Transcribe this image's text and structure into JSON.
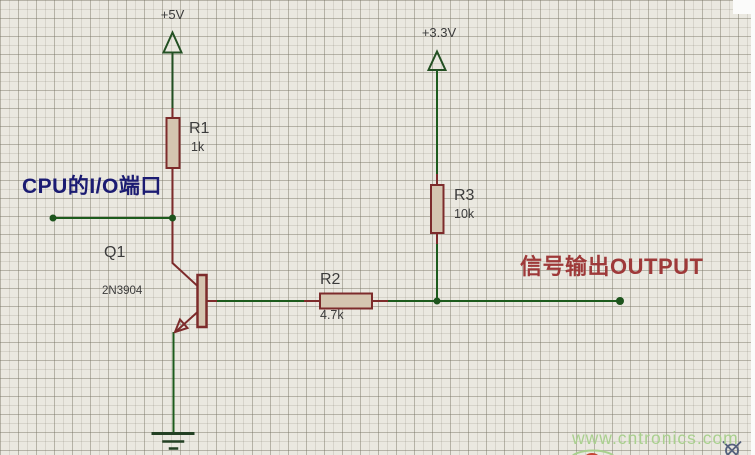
{
  "colors": {
    "background": "#eae8e0",
    "grid_line": "#d2cfc4",
    "wire": "#1c5b1c",
    "pin": "#7d2b2b",
    "component_fill": "#d5c5b0",
    "power": "#235023",
    "ground": "#234023",
    "junction": "#1d541d",
    "label_text": "#3c3c3c",
    "cpu_label": "#1b1b72",
    "output_label": "#9e3939",
    "watermark": "#a9d08e",
    "crosshair": "#54617c",
    "logo_red": "#c74433"
  },
  "power_rails": {
    "v5": "+5V",
    "v33": "+3.3V"
  },
  "components": {
    "r1": {
      "ref": "R1",
      "value": "1k"
    },
    "r2": {
      "ref": "R2",
      "value": "4.7k"
    },
    "r3": {
      "ref": "R3",
      "value": "10k"
    },
    "q1": {
      "ref": "Q1",
      "value": "2N3904"
    }
  },
  "annotations": {
    "cpu_io": "CPU的I/O端口",
    "output": "信号输出OUTPUT"
  },
  "watermark": {
    "text": "www.cntronics.com"
  }
}
